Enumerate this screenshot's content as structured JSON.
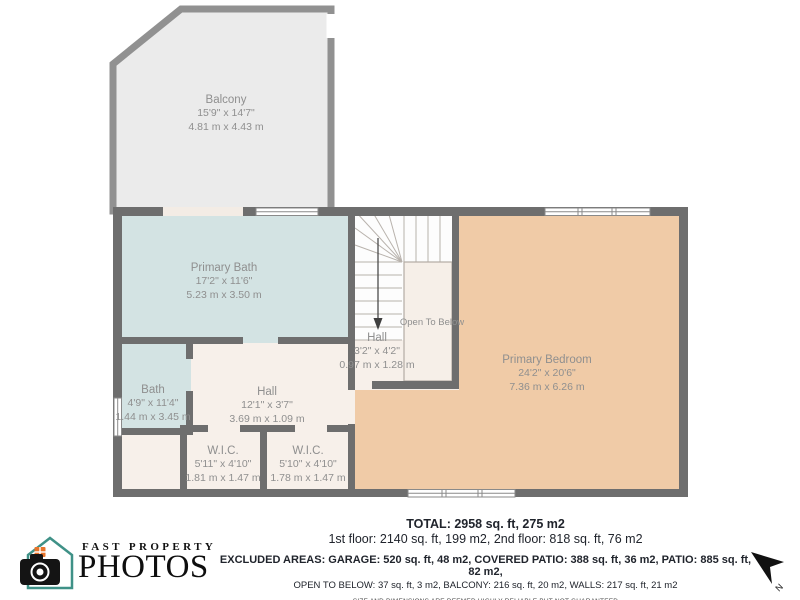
{
  "plan": {
    "rooms": [
      {
        "name": "Balcony",
        "imperial": "15'9\" x 14'7\"",
        "metric": "4.81 m x 4.43 m"
      },
      {
        "name": "Primary Bath",
        "imperial": "17'2\" x 11'6\"",
        "metric": "5.23 m x 3.50 m"
      },
      {
        "name": "Bath",
        "imperial": "4'9\" x 11'4\"",
        "metric": "1.44 m x 3.45 m"
      },
      {
        "name": "Hall",
        "imperial": "12'1\" x 3'7\"",
        "metric": "3.69 m x 1.09 m"
      },
      {
        "name": "Hall",
        "imperial": "3'2\" x 4'2\"",
        "metric": "0.97 m x 1.28 m"
      },
      {
        "name": "W.I.C.",
        "imperial": "5'11\" x 4'10\"",
        "metric": "1.81 m x 1.47 m"
      },
      {
        "name": "W.I.C.",
        "imperial": "5'10\" x 4'10\"",
        "metric": "1.78 m x 1.47 m"
      },
      {
        "name": "Primary Bedroom",
        "imperial": "24'2\" x 20'6\"",
        "metric": "7.36 m x 6.26 m"
      }
    ],
    "open_to_below_label": "Open To Below",
    "north_label": "N"
  },
  "summary": {
    "total": "TOTAL: 2958 sq. ft, 275 m2",
    "floors": "1st floor: 2140 sq. ft, 199 m2, 2nd floor: 818 sq. ft, 76 m2",
    "excluded_line1": "EXCLUDED AREAS: GARAGE: 520 sq. ft, 48 m2, COVERED PATIO: 388 sq. ft, 36 m2, PATIO: 885 sq. ft, 82 m2,",
    "excluded_line2": "OPEN TO BELOW: 37 sq. ft, 3 m2, BALCONY: 216 sq. ft, 20 m2, WALLS: 217 sq. ft, 21 m2",
    "disclaimer": "SIZE AND DIMENSIONS ARE DEEMED HIGHLY RELIABLE BUT NOT GUARANTEED"
  },
  "logo": {
    "line1": "FAST PROPERTY",
    "line2": "PHOTOS"
  },
  "colors": {
    "wall": "#6e6e6e",
    "balcony_wall": "#919191",
    "balcony_fill": "#ebebeb",
    "bath_fill": "#d3e3e3",
    "hall_fill": "#f7f0ea",
    "bedroom_fill": "#f0cba7",
    "stairs_fill": "#fdfdfd",
    "label_text": "#8f8f8f",
    "logo_house_teal": "#3f9187",
    "logo_window_orange": "#e8742b",
    "footer_text": "#20242c"
  }
}
